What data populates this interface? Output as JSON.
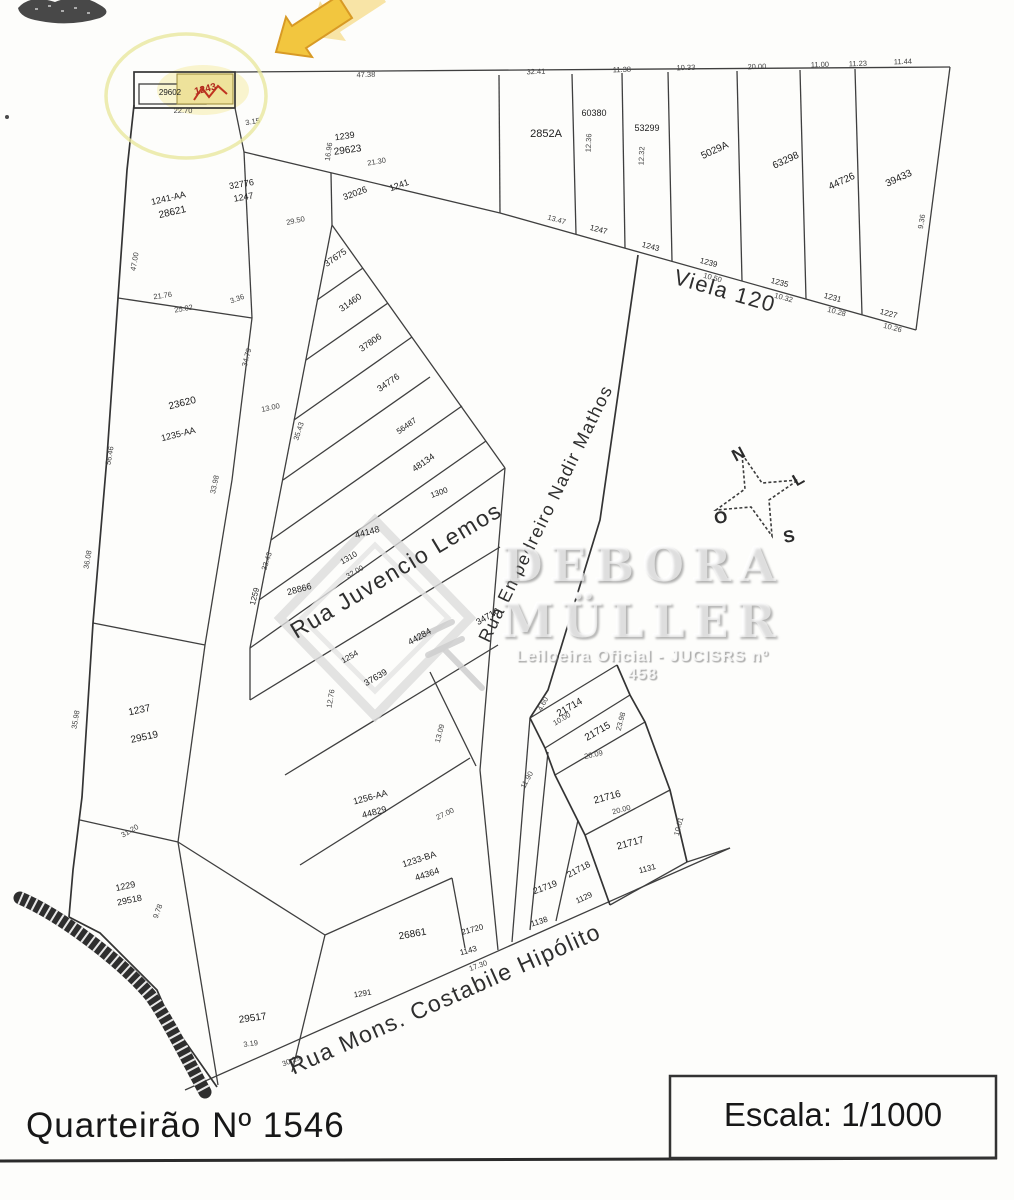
{
  "footer": {
    "block_label": "Quarteirão Nº 1546",
    "scale_label": "Escala: 1/1000"
  },
  "watermark": {
    "line1": "DEBORA",
    "line2": "MÜLLER",
    "line3": "Leiloeira Oficial - JUCISRS nº 458"
  },
  "colors": {
    "arrow_yellow": "#f2c63f",
    "arrow_outline": "#d89a25",
    "highlight_fill": "#eee29b",
    "highlight_ring": "#e9e79f",
    "red_lot": "#b02a1e",
    "ink": "#3f3f3f",
    "stamp": "#3a3a3a"
  },
  "map": {
    "highlight": {
      "lot_number": "1243"
    },
    "streets": [
      {
        "name": "Viela 120",
        "x": 723,
        "y": 298,
        "r": 16,
        "s": 22
      },
      {
        "name": "Rua Juvencio Lemos",
        "x": 400,
        "y": 577,
        "r": -31,
        "s": 23
      },
      {
        "name": "Rua Empedreiro Nadir Mathos",
        "x": 551,
        "y": 516,
        "r": -64,
        "s": 18
      },
      {
        "name": "Rua Mons. Costabile Hipólito",
        "x": 448,
        "y": 1006,
        "r": -24,
        "s": 23
      }
    ],
    "compass_letters": [
      {
        "t": "N",
        "x": 741,
        "y": 459,
        "r": -28
      },
      {
        "t": "L",
        "x": 801,
        "y": 484,
        "r": -30
      },
      {
        "t": "O",
        "x": 722,
        "y": 523,
        "r": -12
      },
      {
        "t": "S",
        "x": 790,
        "y": 542,
        "r": -10
      }
    ],
    "parcel_labels": [
      [
        "29602",
        170,
        95,
        0,
        8
      ],
      [
        "1239",
        345,
        139,
        -8,
        9
      ],
      [
        "29623",
        348,
        153,
        -8,
        10
      ],
      [
        "32776",
        242,
        187,
        -10,
        9
      ],
      [
        "1247",
        244,
        200,
        -10,
        9
      ],
      [
        "1241-AA",
        169,
        201,
        -13,
        9
      ],
      [
        "28621",
        173,
        215,
        -13,
        10
      ],
      [
        "32026",
        356,
        196,
        -20,
        9
      ],
      [
        "1241",
        400,
        188,
        -20,
        9
      ],
      [
        "23620",
        183,
        406,
        -14,
        10
      ],
      [
        "1235-AA",
        179,
        437,
        -14,
        9
      ],
      [
        "1237",
        140,
        713,
        -12,
        10
      ],
      [
        "29519",
        145,
        740,
        -12,
        10
      ],
      [
        "1229",
        126,
        889,
        -12,
        9
      ],
      [
        "29518",
        130,
        903,
        -12,
        9
      ],
      [
        "29517",
        253,
        1021,
        -8,
        10
      ],
      [
        "1291",
        363,
        996,
        -10,
        8
      ],
      [
        "37675",
        337,
        260,
        -35,
        9
      ],
      [
        "31460",
        352,
        305,
        -35,
        9
      ],
      [
        "37806",
        372,
        345,
        -35,
        9
      ],
      [
        "34776",
        390,
        385,
        -35,
        9
      ],
      [
        "56487",
        408,
        428,
        -35,
        8
      ],
      [
        "48134",
        425,
        465,
        -35,
        9
      ],
      [
        "44148",
        368,
        535,
        -15,
        9
      ],
      [
        "28866",
        300,
        592,
        -15,
        9
      ],
      [
        "1310",
        350,
        560,
        -30,
        8
      ],
      [
        "1300",
        440,
        495,
        -20,
        8
      ],
      [
        "1259",
        257,
        597,
        -75,
        8
      ],
      [
        "1254",
        351,
        659,
        -30,
        8
      ],
      [
        "37639",
        377,
        680,
        -30,
        9
      ],
      [
        "44284",
        421,
        639,
        -30,
        9
      ],
      [
        "34716",
        489,
        619,
        -30,
        9
      ],
      [
        "1256-AA",
        371,
        800,
        -15,
        9
      ],
      [
        "44829",
        375,
        815,
        -15,
        9
      ],
      [
        "1233-BA",
        420,
        862,
        -18,
        9
      ],
      [
        "44364",
        428,
        877,
        -18,
        9
      ],
      [
        "26861",
        413,
        937,
        -10,
        10
      ],
      [
        "21720",
        473,
        932,
        -15,
        8
      ],
      [
        "1143",
        469,
        953,
        -15,
        8
      ],
      [
        "21714",
        571,
        710,
        -30,
        10
      ],
      [
        "21715",
        599,
        734,
        -30,
        10
      ],
      [
        "21716",
        608,
        800,
        -15,
        10
      ],
      [
        "21717",
        631,
        846,
        -15,
        10
      ],
      [
        "21718",
        580,
        872,
        -28,
        9
      ],
      [
        "1129",
        585,
        900,
        -25,
        8
      ],
      [
        "21719",
        546,
        890,
        -20,
        9
      ],
      [
        "1138",
        540,
        924,
        -18,
        8
      ],
      [
        "1131",
        648,
        871,
        -15,
        8
      ],
      [
        "2852A",
        546,
        137,
        0,
        11
      ],
      [
        "60380",
        594,
        116,
        0,
        9
      ],
      [
        "53299",
        647,
        131,
        0,
        9
      ],
      [
        "5029A",
        716,
        153,
        -25,
        10
      ],
      [
        "63298",
        787,
        163,
        -25,
        10
      ],
      [
        "44726",
        843,
        184,
        -25,
        10
      ],
      [
        "39433",
        900,
        181,
        -25,
        10
      ],
      [
        "1247",
        598,
        232,
        15,
        8
      ],
      [
        "1243",
        650,
        249,
        15,
        8
      ],
      [
        "1239",
        708,
        265,
        15,
        8
      ],
      [
        "1235",
        779,
        285,
        15,
        8
      ],
      [
        "1231",
        832,
        300,
        15,
        8
      ],
      [
        "1227",
        888,
        316,
        15,
        8
      ]
    ],
    "measure_labels": [
      [
        "22.70",
        183,
        113,
        0
      ],
      [
        "3.15",
        253,
        124,
        -10
      ],
      [
        "21.30",
        377,
        164,
        -10
      ],
      [
        "16.96",
        331,
        152,
        -82
      ],
      [
        "29.50",
        296,
        223,
        -12
      ],
      [
        "47.00",
        137,
        262,
        -80
      ],
      [
        "21.76",
        163,
        298,
        -8
      ],
      [
        "3.36",
        238,
        301,
        -20
      ],
      [
        "25.02",
        184,
        311,
        -10
      ],
      [
        "34.79",
        249,
        358,
        -75
      ],
      [
        "13.00",
        271,
        410,
        -12
      ],
      [
        "33.98",
        217,
        485,
        -78
      ],
      [
        "56.46",
        112,
        456,
        -80
      ],
      [
        "36.08",
        90,
        560,
        -80
      ],
      [
        "35.98",
        78,
        720,
        -80
      ],
      [
        "31.20",
        131,
        833,
        -30
      ],
      [
        "9.78",
        160,
        912,
        -70
      ],
      [
        "3.19",
        251,
        1046,
        -8
      ],
      [
        "30.29",
        292,
        1063,
        -22
      ],
      [
        "12.76",
        333,
        699,
        -80
      ],
      [
        "13.09",
        442,
        734,
        -75
      ],
      [
        "32.00",
        356,
        574,
        -30
      ],
      [
        "27.00",
        446,
        816,
        -25
      ],
      [
        "17.30",
        479,
        968,
        -20
      ],
      [
        "10.00",
        563,
        721,
        -30
      ],
      [
        "23.98",
        623,
        722,
        -75
      ],
      [
        "20.09",
        594,
        757,
        -12
      ],
      [
        "20.00",
        622,
        812,
        -15
      ],
      [
        "10.01",
        681,
        827,
        -75
      ],
      [
        "11.90",
        529,
        781,
        -62
      ],
      [
        "4.60",
        545,
        705,
        -62
      ],
      [
        "12.36",
        591,
        143,
        -87
      ],
      [
        "12.32",
        644,
        156,
        -87
      ],
      [
        "9.36",
        924,
        222,
        -80
      ],
      [
        "47.38",
        366,
        77,
        -2
      ],
      [
        "32.41",
        536,
        74,
        -2
      ],
      [
        "11.38",
        622,
        72,
        -2
      ],
      [
        "10.33",
        686,
        70,
        -2
      ],
      [
        "20.00",
        757,
        69,
        -2
      ],
      [
        "11.00",
        820,
        67,
        -2
      ],
      [
        "11.23",
        858,
        66,
        -2
      ],
      [
        "11.44",
        903,
        64,
        -2
      ],
      [
        "13.47",
        556,
        222,
        16
      ],
      [
        "10.50",
        712,
        280,
        15
      ],
      [
        "10.32",
        783,
        300,
        15
      ],
      [
        "10.28",
        836,
        314,
        15
      ],
      [
        "10.26",
        892,
        330,
        15
      ],
      [
        "35.43",
        301,
        432,
        -72
      ],
      [
        "33.43",
        269,
        562,
        -72
      ]
    ],
    "lines": [
      [
        235,
        72,
        950,
        67
      ],
      [
        950,
        67,
        916,
        330
      ],
      [
        500,
        213,
        916,
        330
      ],
      [
        499,
        75,
        500,
        213
      ],
      [
        572,
        74,
        576,
        234
      ],
      [
        622,
        73,
        625,
        248
      ],
      [
        668,
        72,
        672,
        261
      ],
      [
        737,
        71,
        742,
        281
      ],
      [
        800,
        70,
        806,
        299
      ],
      [
        855,
        69,
        862,
        315
      ],
      [
        235,
        108,
        244,
        152
      ],
      [
        244,
        152,
        500,
        213
      ],
      [
        244,
        152,
        252,
        318
      ],
      [
        118,
        298,
        252,
        318
      ],
      [
        93,
        623,
        205,
        645
      ],
      [
        80,
        820,
        178,
        842
      ],
      [
        252,
        318,
        232,
        480
      ],
      [
        232,
        480,
        205,
        645
      ],
      [
        205,
        645,
        178,
        842
      ],
      [
        178,
        842,
        218,
        1085
      ],
      [
        178,
        842,
        325,
        935
      ],
      [
        325,
        935,
        292,
        1072
      ],
      [
        325,
        935,
        452,
        878
      ],
      [
        332,
        225,
        250,
        648
      ],
      [
        332,
        225,
        505,
        468
      ],
      [
        317,
        300,
        363,
        268
      ],
      [
        306,
        360,
        388,
        303
      ],
      [
        294,
        420,
        412,
        337
      ],
      [
        283,
        480,
        430,
        377
      ],
      [
        271,
        540,
        462,
        406
      ],
      [
        259,
        600,
        486,
        441
      ],
      [
        250,
        648,
        505,
        468
      ],
      [
        505,
        468,
        480,
        770
      ],
      [
        480,
        770,
        498,
        950
      ],
      [
        250,
        700,
        500,
        547
      ],
      [
        250,
        648,
        250,
        700
      ],
      [
        285,
        775,
        498,
        645
      ],
      [
        300,
        865,
        470,
        758
      ],
      [
        430,
        672,
        476,
        766
      ],
      [
        452,
        878,
        465,
        948
      ],
      [
        331,
        173,
        332,
        225
      ],
      [
        530,
        718,
        617,
        665
      ],
      [
        545,
        748,
        630,
        695
      ],
      [
        555,
        775,
        645,
        722
      ],
      [
        585,
        835,
        670,
        790
      ],
      [
        610,
        905,
        687,
        862
      ],
      [
        548,
        752,
        530,
        930
      ],
      [
        578,
        820,
        556,
        921
      ],
      [
        530,
        718,
        512,
        942
      ],
      [
        185,
        1090,
        730,
        848
      ],
      [
        687,
        862,
        730,
        848
      ]
    ],
    "polylines": [
      "134,105 127,170 118,298 107,457 93,623 82,797 73,870 69,917",
      "69,917 100,933 157,990 170,1020 217,1087",
      "617,665 630,695 645,722 670,790 687,862",
      "530,718 545,748 555,775 585,835 610,905",
      "638,255 600,520 548,690 530,718"
    ]
  }
}
